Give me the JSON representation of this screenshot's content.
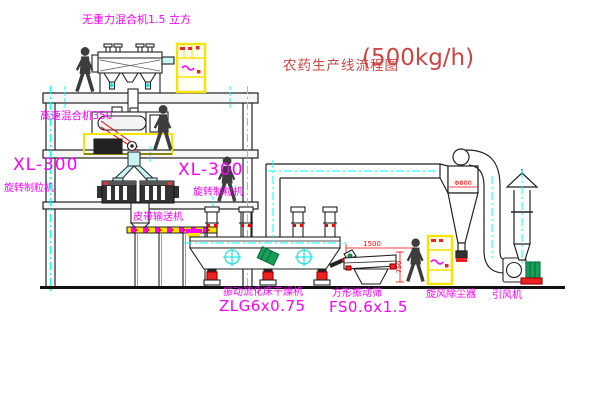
{
  "title": {
    "name": "农药生产线流程图",
    "capacity": "(500kg/h)"
  },
  "labels": {
    "gravity_mixer": "无重力混合机1.5 立方",
    "high_speed_mixer": "高速混合机350",
    "granulator_left_model": "XL-300",
    "granulator_left_name": "旋转制粒机",
    "granulator_right_model": "XL-300",
    "granulator_right_name": "旋转制粒机",
    "belt_conveyor": "皮带输送机",
    "dryer_name": "振动流化床干燥机",
    "dryer_model": "ZLG6x0.75",
    "sieve_name": "方形振动筛",
    "sieve_model": "FS0.6x1.5",
    "cyclone_name": "旋风除尘器",
    "fan_name": "引风机"
  },
  "dimensions": {
    "sieve_width": "1500",
    "sieve_height": "750",
    "cyclone_diameter": "Φ800"
  },
  "colors": {
    "label_magenta": "#ff00ff",
    "title_red": "#cc4444",
    "dimension_red": "#ff0000",
    "centerline_cyan": "#00ffff",
    "cabinet_yellow": "#f5e400",
    "motor_green": "#15a05a",
    "line_black": "#222222"
  }
}
